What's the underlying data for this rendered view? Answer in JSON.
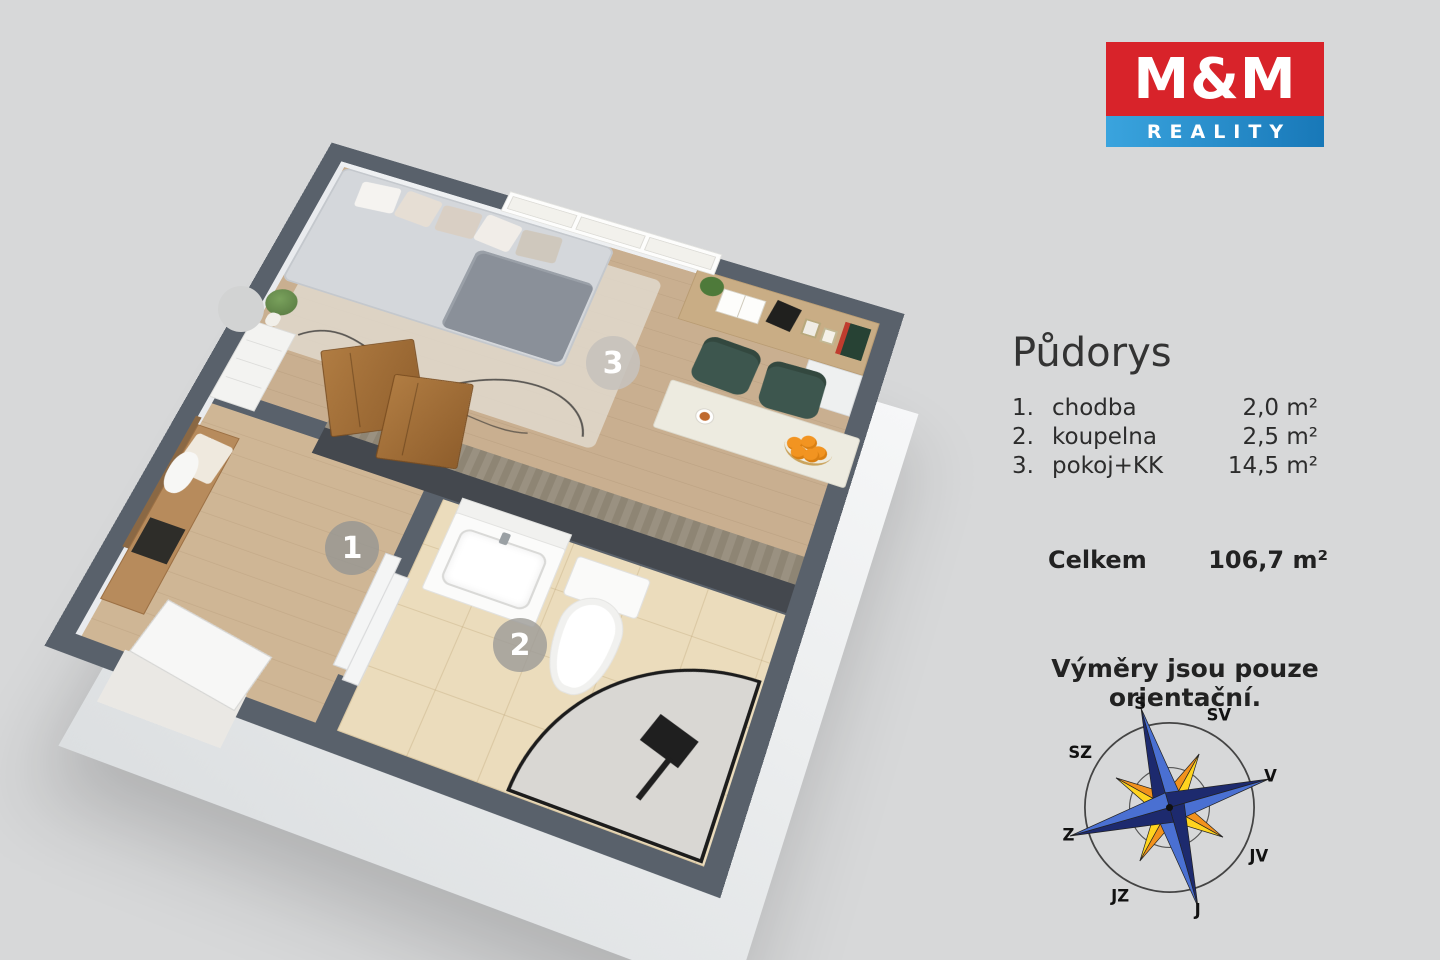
{
  "branding": {
    "logo_top": "M&M",
    "logo_bottom": "REALITY",
    "colors": {
      "red": "#d8232a",
      "blue_light": "#3aa4de",
      "blue_dark": "#1878b8"
    }
  },
  "panel": {
    "title": "Půdorys",
    "rooms": [
      {
        "num": "1.",
        "name": "chodba",
        "area": "2,0 m²"
      },
      {
        "num": "2.",
        "name": "koupelna",
        "area": "2,5 m²"
      },
      {
        "num": "3.",
        "name": "pokoj+KK",
        "area": "14,5 m²"
      }
    ],
    "total_label": "Celkem",
    "total_area": "106,7 m²",
    "disclaimer": "Výměry jsou pouze orientační."
  },
  "floorplan": {
    "badges": [
      "1",
      "2",
      "3"
    ],
    "wall_color": "#59616b"
  },
  "compass": {
    "labels": {
      "n": "S",
      "ne": "SV",
      "e": "V",
      "se": "JV",
      "s": "J",
      "sw": "JZ",
      "w": "Z",
      "nw": "SZ"
    }
  }
}
